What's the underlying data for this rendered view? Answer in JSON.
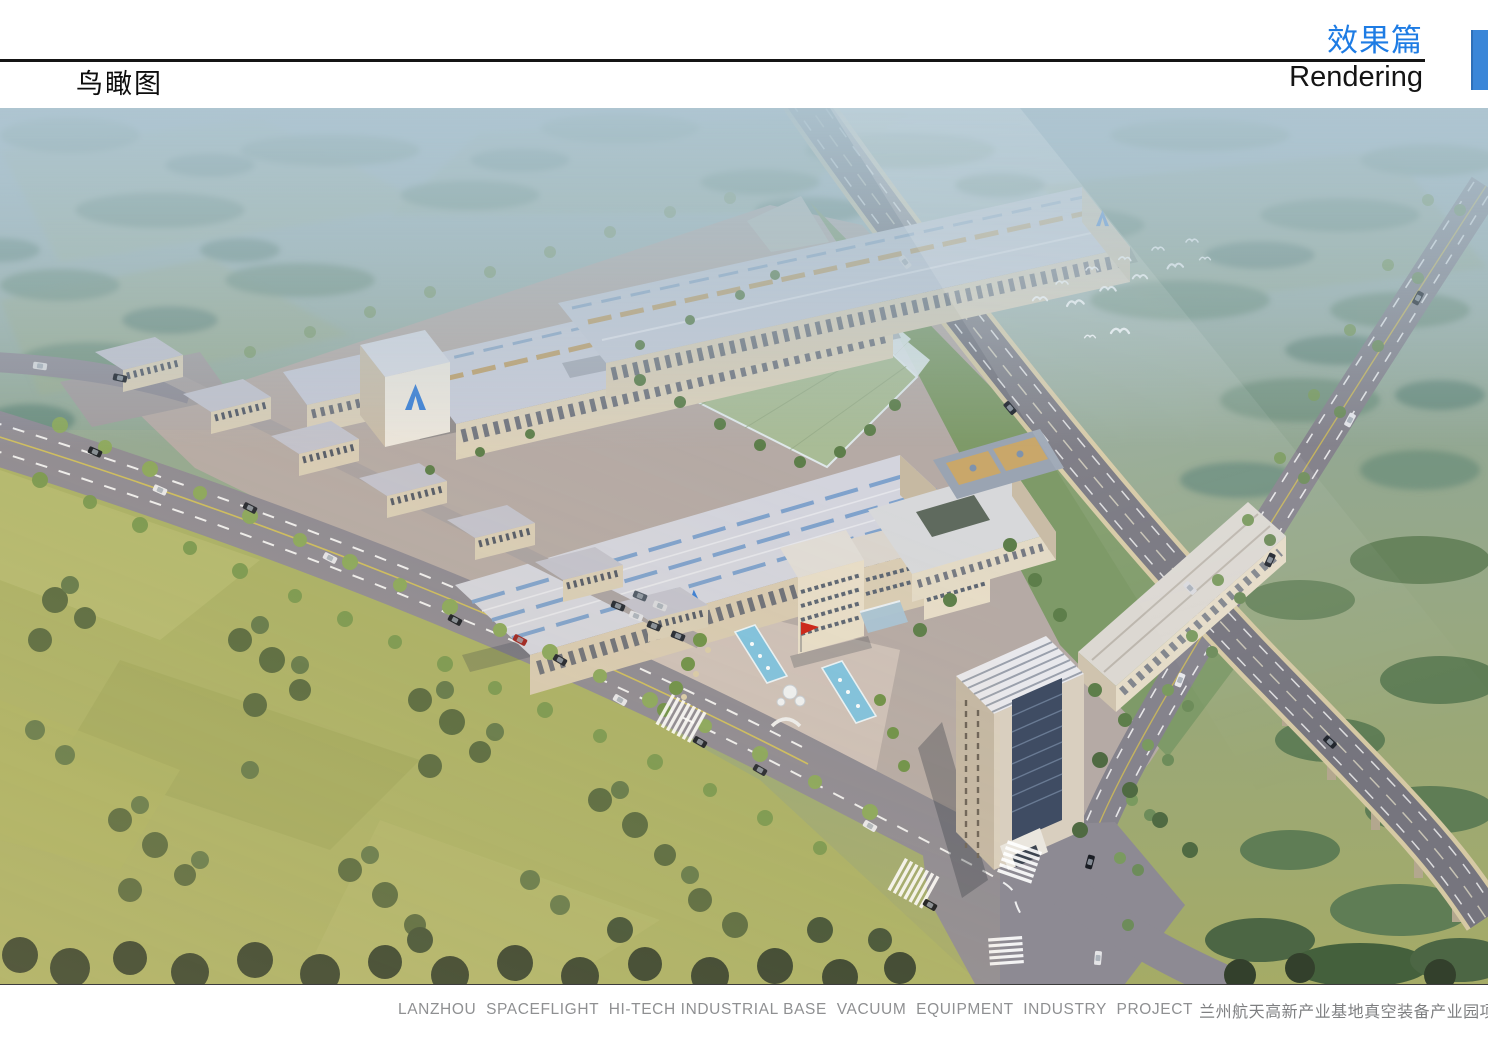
{
  "header": {
    "section_title_zh": "效果篇",
    "section_title_en": "Rendering",
    "page_title": "鸟瞰图"
  },
  "footer": {
    "caption_en": "LANZHOU  SPACEFLIGHT  HI-TECH INDUSTRIAL BASE  VACUUM  EQUIPMENT  INDUSTRY  PROJECT",
    "caption_zh": "兰州航天高新产业基地真空装备产业园项目"
  },
  "colors": {
    "accent_blue": "#1e7ce4",
    "tab_blue": "#3a86d8",
    "caption_gray": "#8f9092",
    "logo_blue": "#3b7fd4"
  }
}
